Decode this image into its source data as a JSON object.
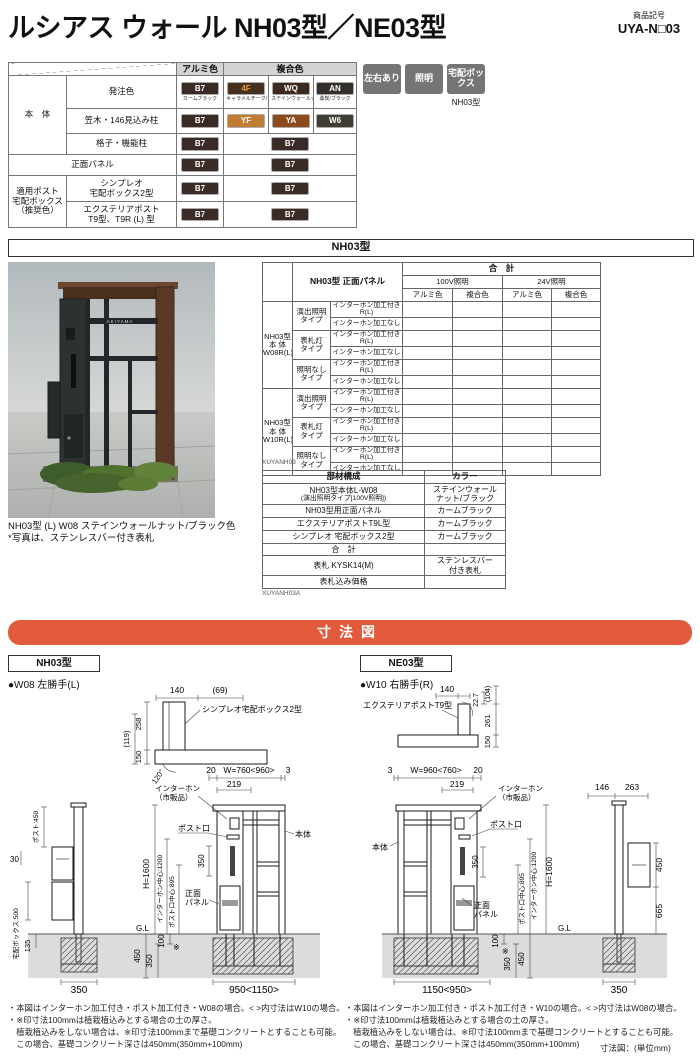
{
  "header": {
    "title": "ルシアス ウォール NH03型／NE03型",
    "code_label": "商品記号",
    "code": "UYA-N□03"
  },
  "badges": {
    "items": [
      "左右あり",
      "照明",
      "宅配ボックス"
    ],
    "caption": "NH03型"
  },
  "palette": {
    "accent_orange": "#e05a3b",
    "badge_gray": "#757575",
    "table_header_gray": "#d4d4d4",
    "chip_B7": "#3a2b27",
    "chip_4F": "#45301e",
    "chip_WQ": "#3d2a1e",
    "chip_AN": "#34302b",
    "chip_YF": "#c17c33",
    "chip_YA": "#8d4b1c",
    "chip_W6": "#403e34"
  },
  "color_table": {
    "head_alumi": "アルミ色",
    "head_fukugo": "複合色",
    "label_hontai": "本　体",
    "label_order": "発注色",
    "label_kasagi": "笠木・146見込み柱",
    "label_koushi": "格子・機能柱",
    "label_panel": "正面パネル",
    "label_post_group": [
      "適用ポスト",
      "宅配ボックス",
      "（推奨色）"
    ],
    "label_simpleo": [
      "シンプレオ",
      "宅配ボックス2型"
    ],
    "label_exterior": [
      "エクステリアポスト",
      "T9型、T9R (L) 型"
    ],
    "chips_order": [
      {
        "code": "B7",
        "name": "カームブラック"
      },
      {
        "code": "4F",
        "name": "キャラメルチーク/ブラック"
      },
      {
        "code": "WQ",
        "name": "ステインウォールナット/ブラック"
      },
      {
        "code": "AN",
        "name": "桑炭/ブラック"
      }
    ],
    "chips_kasagi": [
      "B7",
      "YF",
      "YA",
      "W6"
    ],
    "chips_koushi": [
      "B7",
      "B7"
    ],
    "chips_panel": [
      "B7",
      "B7"
    ],
    "chips_simpleo": [
      "B7",
      "B7"
    ],
    "chips_exterior": [
      "B7",
      "B7"
    ]
  },
  "nh03_bar": "NH03型",
  "photo": {
    "nameplate": "AKIYAMA",
    "caption1": "NH03型 (L) W08 ステインウォールナット/ブラック色",
    "caption2": "*写真は、ステンレスバー付き表札"
  },
  "price_table": {
    "head_left": "NH03型 正面パネル",
    "head_total": "合　計",
    "head_100v": "100V照明",
    "head_24v": "24V照明",
    "head_alumi": "アルミ色",
    "head_fukugo": "複合色",
    "group1": [
      "NH03型",
      "本 体",
      "W08R(L)"
    ],
    "group2": [
      "NH03型",
      "本 体",
      "W10R(L)"
    ],
    "types": [
      [
        "演出照明",
        "タイプ"
      ],
      [
        "表札灯",
        "タイプ"
      ],
      [
        "照明なし",
        "タイプ"
      ]
    ],
    "opt_with": "インターホン加工付きR(L)",
    "opt_without": "インターホン加工なし",
    "code": "XUYANH03"
  },
  "parts_table": {
    "head_part": "部材構成",
    "head_color": "カラー",
    "rows": [
      {
        "p1": "NH03型本体L-W08",
        "p2": "(演出照明タイプ[100V照明])",
        "c1": "ステインウォール",
        "c2": "ナット/ブラック"
      },
      {
        "p1": "NH03型用正面パネル",
        "c1": "カームブラック"
      },
      {
        "p1": "エクステリアポストT9L型",
        "c1": "カームブラック"
      },
      {
        "p1": "シンプレオ 宅配ボックス2型",
        "c1": "カームブラック"
      },
      {
        "p1": "合　計",
        "c1": ""
      },
      {
        "p1": "表札 KYSK14(M)",
        "c1": "ステンレスバー",
        "c2": "付き表札"
      },
      {
        "p1": "表札込み価格",
        "c1": ""
      }
    ],
    "code": "XUYANH03A"
  },
  "dims": {
    "bar": "寸法図",
    "unit": "寸法図：(単位mm)",
    "left": {
      "tag": "NH03型",
      "subtitle": "●W08 左勝手(L)",
      "plan": {
        "d140": "140",
        "d69": "(69)",
        "d258": "258",
        "d150": "150",
        "d119": "(119)",
        "deg": "120°",
        "label": "シンプレオ宅配ボックス2型"
      },
      "elev": {
        "d20": "20",
        "w": "W=760<960>",
        "d3": "3",
        "d219": "219",
        "ip1": "インターホン",
        "ip2": "（市販品）",
        "slot": "ポスト口",
        "body": "本体",
        "d350": "350",
        "pn1": "正面",
        "pn2": "パネル",
        "h": "H=1600",
        "ic": "インターホン中心:1200",
        "pc": "ポスト口中心:895",
        "gl": "G.L",
        "g450": "450",
        "g350": "350",
        "g100": "100",
        "kome": "※",
        "wb": "950<1150>"
      },
      "side": {
        "post": "ポスト:450",
        "d30": "30",
        "box": "宅配ボックス:500",
        "d135": "135",
        "d350": "350"
      }
    },
    "right": {
      "tag": "NE03型",
      "subtitle": "●W10 右勝手(R)",
      "plan": {
        "d140": "140",
        "d227": "22.7",
        "d104": "(104)",
        "d261": "261",
        "d150": "150",
        "label": "エクステリアポストT9型"
      },
      "elev": {
        "d3": "3",
        "w": "W=960<760>",
        "d20": "20",
        "d219": "219",
        "ip1": "インターホン",
        "ip2": "（市販品）",
        "slot": "ポスト口",
        "body": "本体",
        "d350": "350",
        "pn1": "正面",
        "pn2": "パネル",
        "h": "H=1600",
        "ic": "インターホン中心:1200",
        "pc": "ポスト口中心:895",
        "gl": "G.L",
        "g100": "100",
        "kome": "※",
        "g350": "350",
        "g450": "450",
        "wb": "1150<950>"
      },
      "side": {
        "d146": "146",
        "d263": "263",
        "d450": "450",
        "d665": "665",
        "d350": "350"
      }
    }
  },
  "footnotes": {
    "left": [
      "・本図はインターホン加工付き・ポスト加工付き・W08の場合。< >内寸法はW10の場合。",
      "・※印寸法100mmは植栽植込みとする場合の土の厚さ。",
      "　植栽植込みをしない場合は、※印寸法100mmまで基礎コンクリートとすることも可能。",
      "　この場合、基礎コンクリート深さは450mm(350mm+100mm)"
    ],
    "right": [
      "・本図はインターホン加工付き・ポスト加工付き・W10の場合。< >内寸法はW08の場合。",
      "・※印寸法100mmは植栽植込みとする場合の土の厚さ。",
      "　植栽植込みをしない場合は、※印寸法100mmまで基礎コンクリートとすることも可能。",
      "　この場合、基礎コンクリート深さは450mm(350mm+100mm)"
    ]
  }
}
